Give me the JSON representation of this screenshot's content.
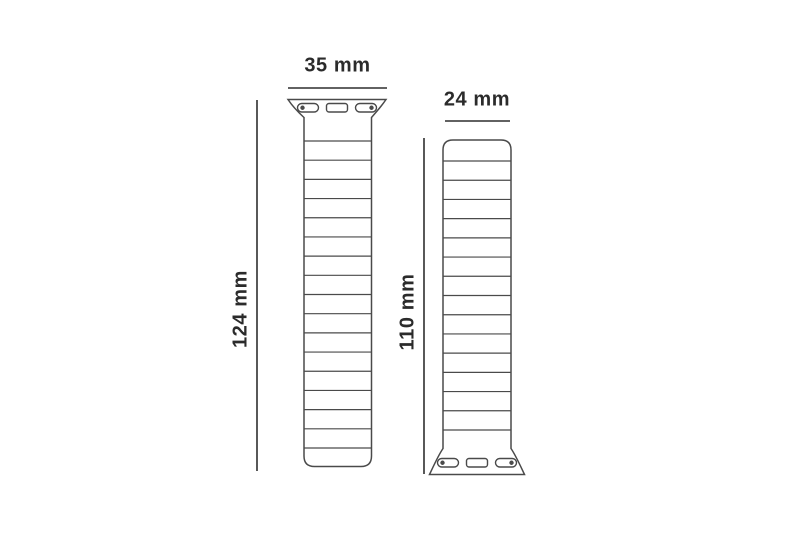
{
  "diagram": {
    "type": "technical-dimension-drawing",
    "subject": "watch-band-size-diagram",
    "bands": [
      {
        "name": "band-long",
        "connector_position": "top",
        "width_label": "35 mm",
        "length_label": "124 mm",
        "width_mm": 35,
        "length_mm": 124,
        "segment_line_count": 17
      },
      {
        "name": "band-short",
        "connector_position": "bottom",
        "width_label": "24 mm",
        "length_label": "110 mm",
        "width_mm": 24,
        "length_mm": 110,
        "segment_line_count": 15
      }
    ],
    "colors": {
      "background": "#ffffff",
      "outline": "#4a4a4a",
      "dimension_line": "#2f2f2f",
      "text": "#2b2b2b"
    }
  }
}
